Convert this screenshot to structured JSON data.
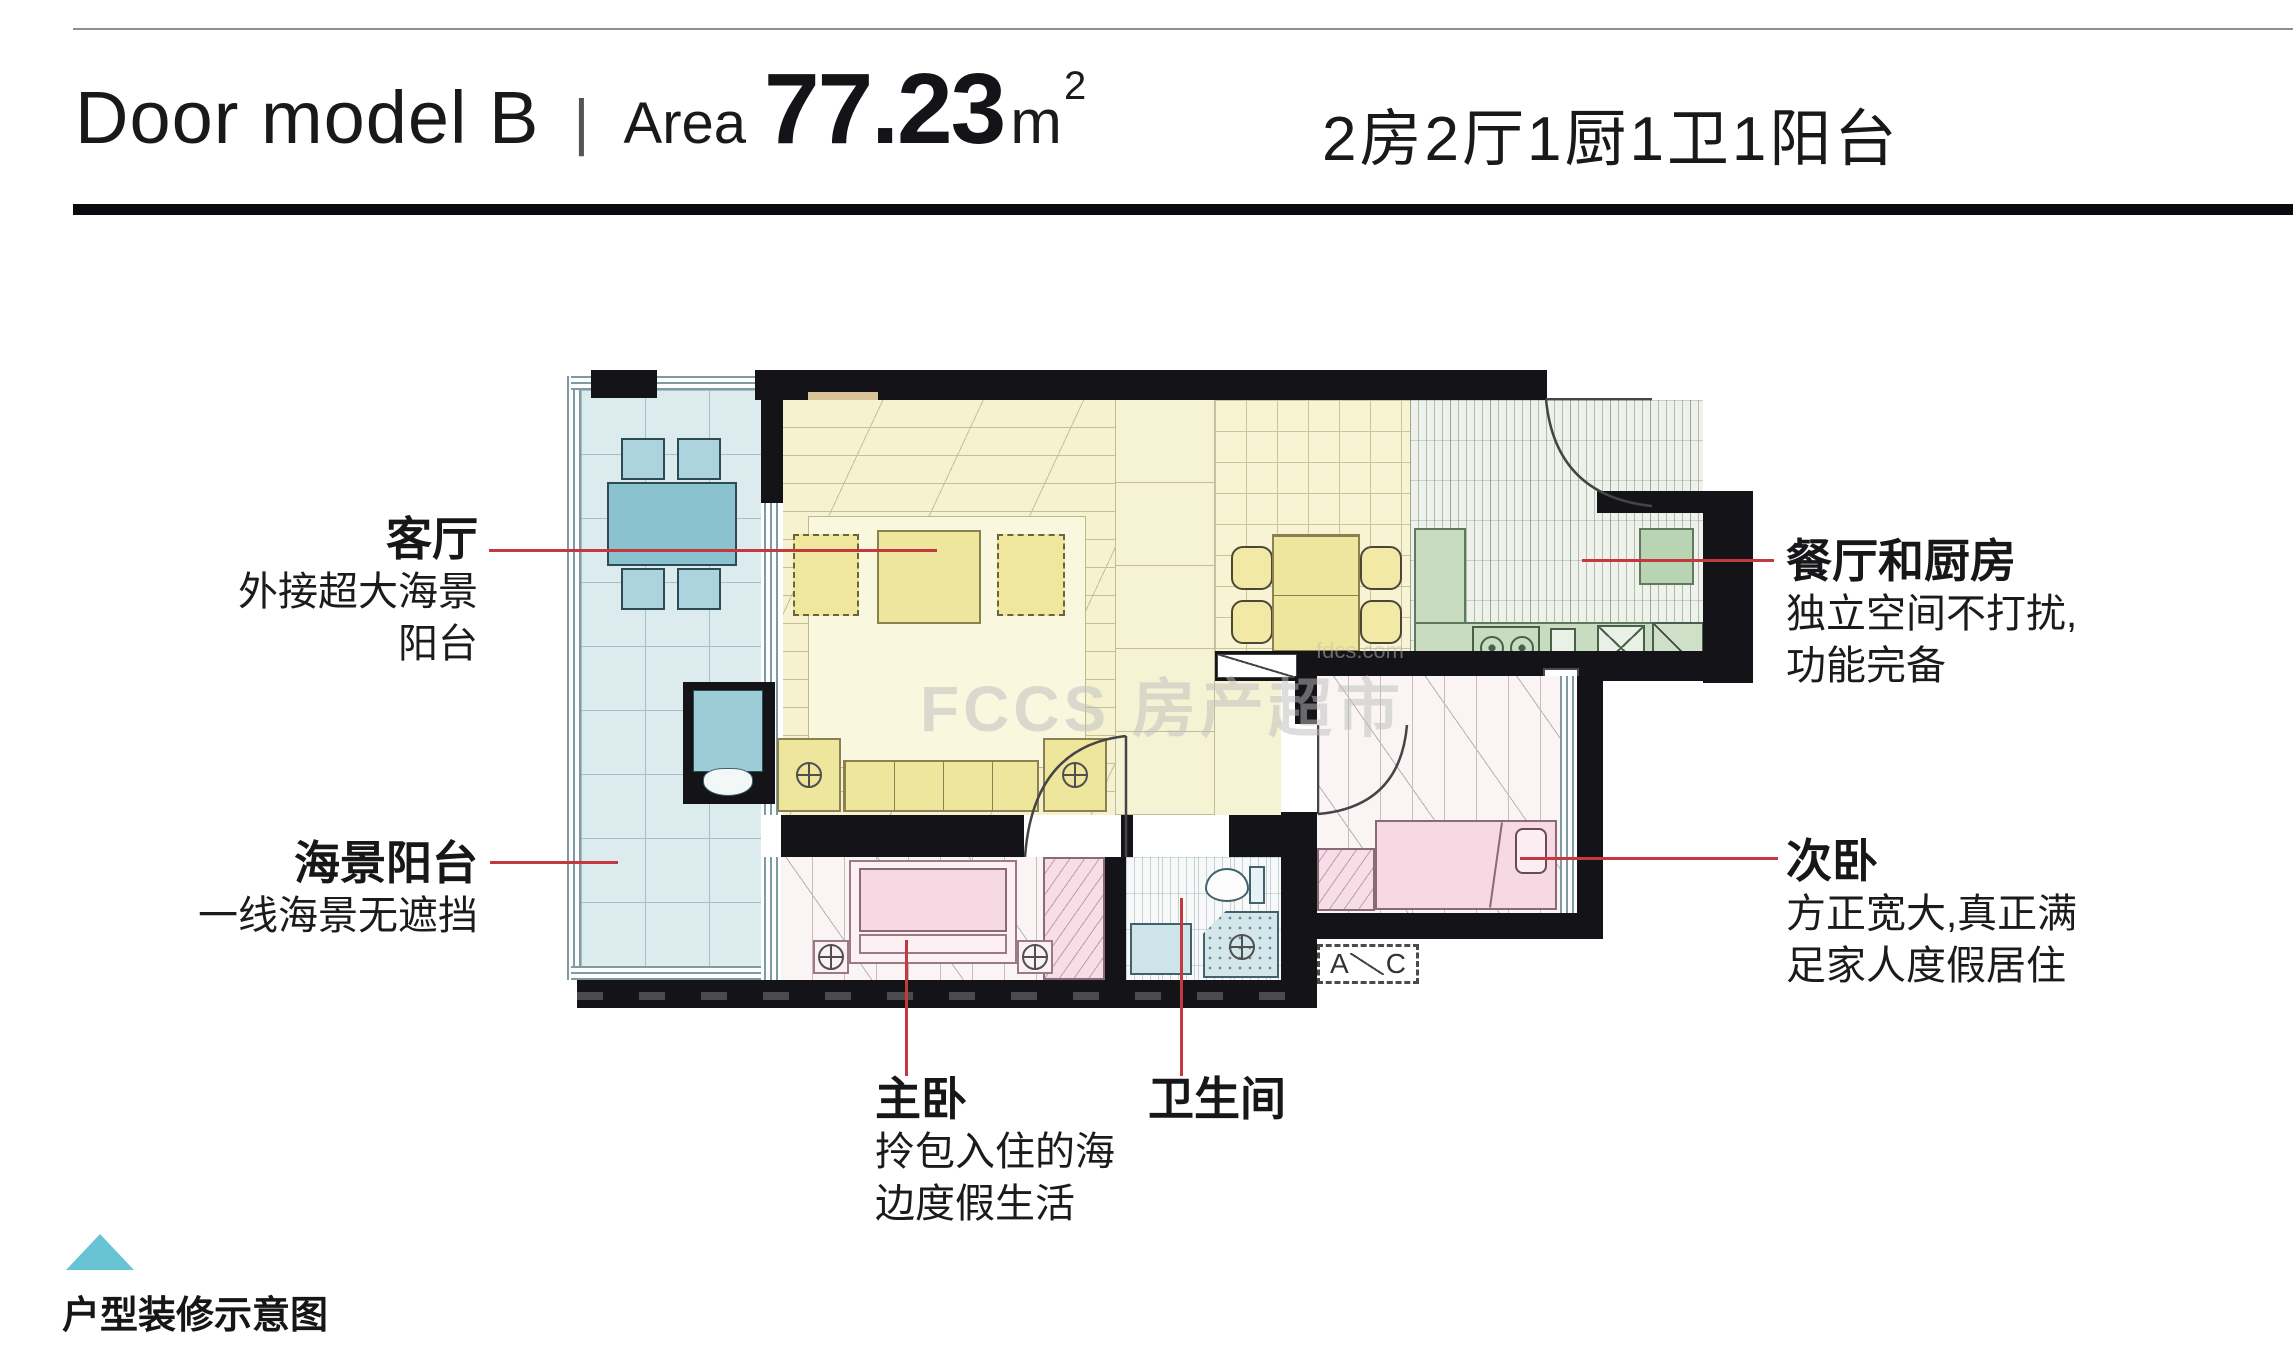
{
  "header": {
    "title_en": "Door model B",
    "divider": "|",
    "area_label": "Area",
    "area_value": "77.23",
    "area_unit": "m",
    "area_sup": "2",
    "layout_cn": "2房2厅1厨1卫1阳台"
  },
  "annotations": {
    "living": {
      "title": "客厅",
      "line1": "外接超大海景",
      "line2": "阳台"
    },
    "sea_balcony": {
      "title": "海景阳台",
      "line1": "一线海景无遮挡"
    },
    "dining_kitchen": {
      "title": "餐厅和厨房",
      "line1": "独立空间不打扰,",
      "line2": "功能完备"
    },
    "second_bedroom": {
      "title": "次卧",
      "line1": "方正宽大,真正满",
      "line2": "足家人度假居住"
    },
    "master_bedroom": {
      "title": "主卧",
      "line1": "拎包入住的海",
      "line2": "边度假生活"
    },
    "bathroom": {
      "title": "卫生间"
    }
  },
  "plan_labels": {
    "gas": "燃",
    "ac_left": "A",
    "ac_right": "C"
  },
  "watermark": {
    "logo": "FCCS",
    "brand": "房产超市",
    "domain": "fdcs.com"
  },
  "footer": {
    "caption": "户型装修示意图"
  },
  "colors": {
    "accent_red": "#c4393d",
    "triangle_teal": "#68c3d3",
    "rule_black": "#0b0b0f"
  }
}
